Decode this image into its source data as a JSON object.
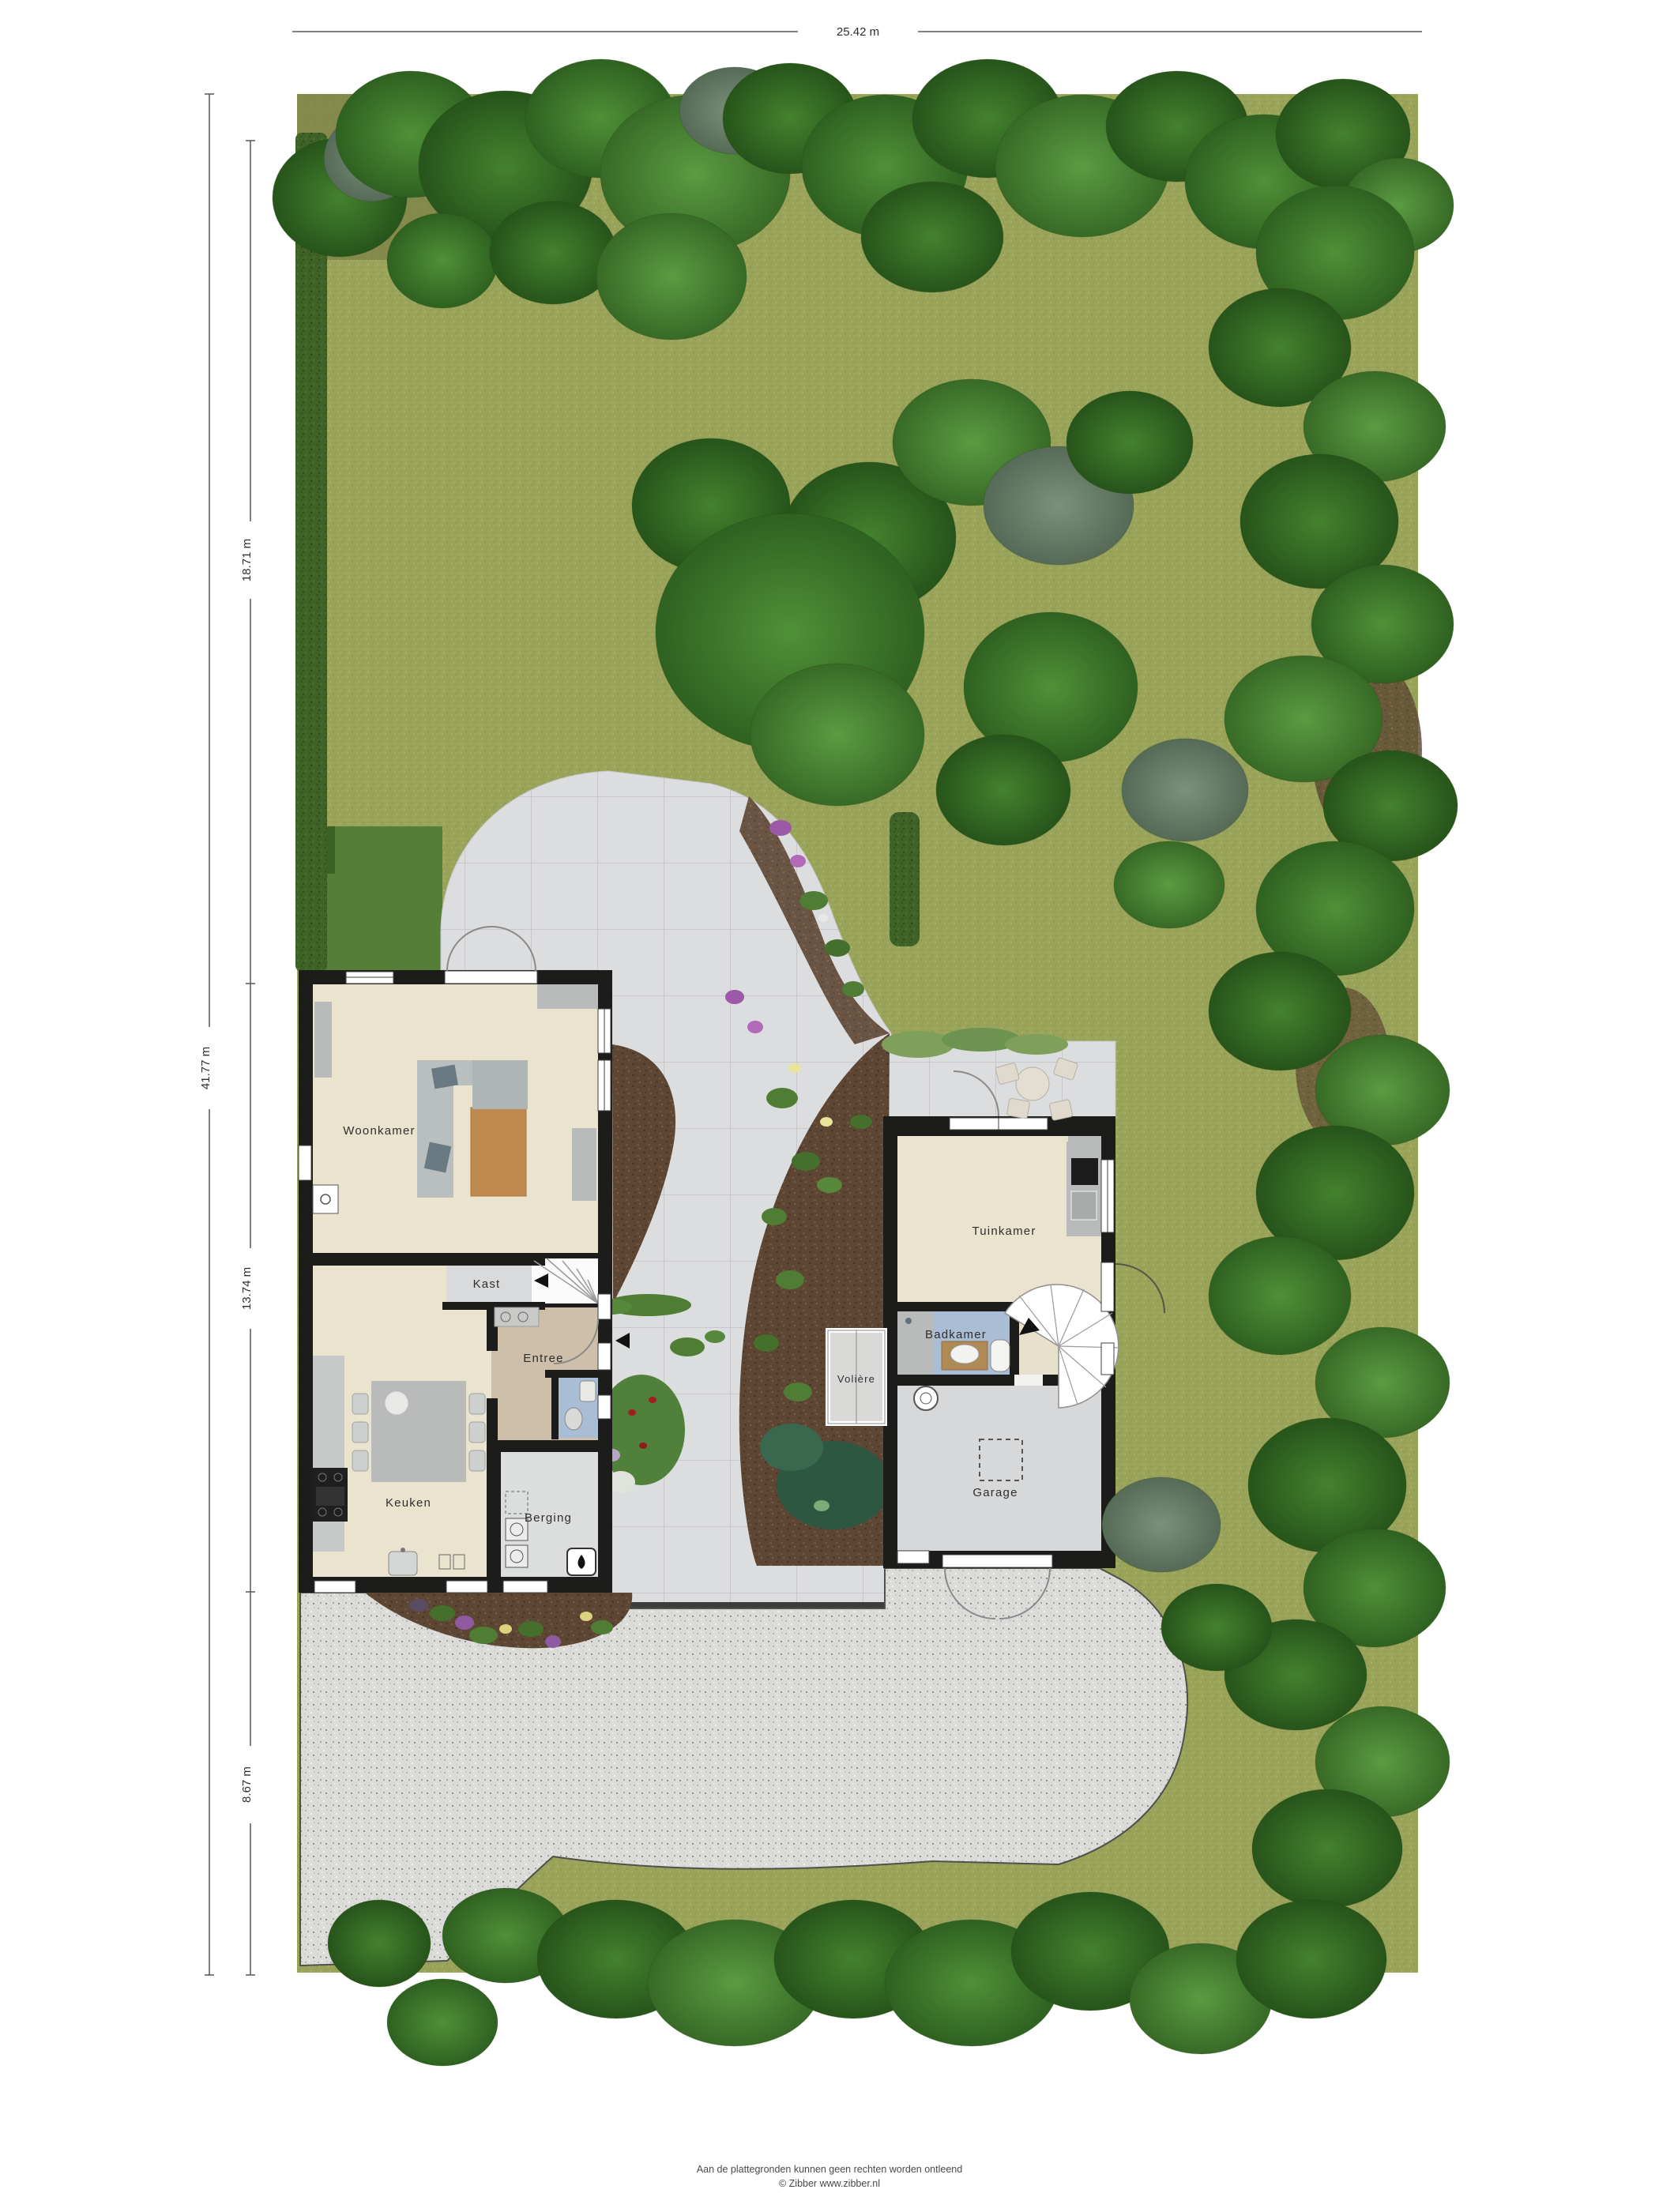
{
  "site": {
    "dimensions": {
      "top": "25.42 m",
      "left_total": "41.77 m",
      "left_segment_top": "18.71 m",
      "left_segment_middle": "13.74 m",
      "left_segment_bottom": "8.67 m"
    },
    "rooms": {
      "woonkamer": "Woonkamer",
      "kast": "Kast",
      "entree": "Entree",
      "keuken": "Keuken",
      "berging": "Berging",
      "tuinkamer": "Tuinkamer",
      "badkamer": "Badkamer",
      "voliere": "Volière",
      "garage": "Garage"
    },
    "footer": {
      "disclaimer": "Aan de plattegronden kunnen geen rechten worden ontleend",
      "credit": "© Zibber www.zibber.nl"
    },
    "palette": {
      "grass": "#9aa35a",
      "tree_green": "#3e7a2b",
      "patio_tile": "#dcdddf",
      "gravel": "#dbdbd9",
      "soil": "#5d4633",
      "wall": "#1c1c1a",
      "floor_beige": "#eae4cf",
      "floor_entree": "#cdbfa9",
      "floor_bath_blue": "#a9bed5",
      "floor_gray": "#d7d8d9"
    }
  }
}
